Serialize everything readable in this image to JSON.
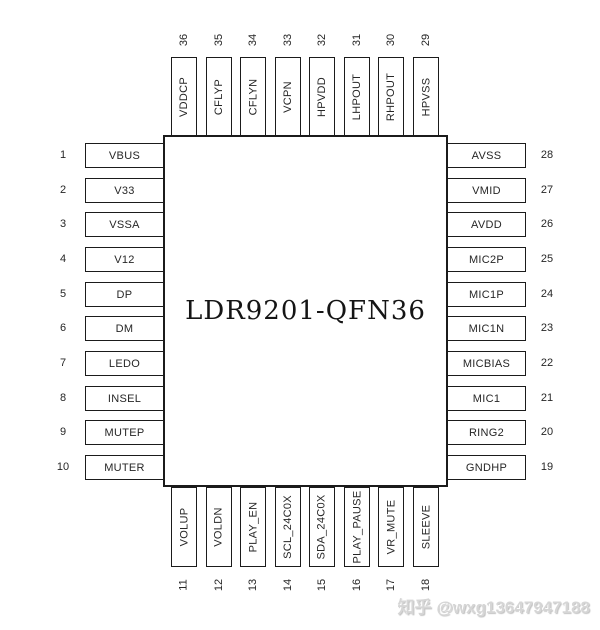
{
  "chip": {
    "label": "LDR9201-QFN36"
  },
  "left_pins": [
    {
      "num": "1",
      "label": "VBUS"
    },
    {
      "num": "2",
      "label": "V33"
    },
    {
      "num": "3",
      "label": "VSSA"
    },
    {
      "num": "4",
      "label": "V12"
    },
    {
      "num": "5",
      "label": "DP"
    },
    {
      "num": "6",
      "label": "DM"
    },
    {
      "num": "7",
      "label": "LEDO"
    },
    {
      "num": "8",
      "label": "INSEL"
    },
    {
      "num": "9",
      "label": "MUTEP"
    },
    {
      "num": "10",
      "label": "MUTER"
    }
  ],
  "right_pins": [
    {
      "num": "28",
      "label": "AVSS"
    },
    {
      "num": "27",
      "label": "VMID"
    },
    {
      "num": "26",
      "label": "AVDD"
    },
    {
      "num": "25",
      "label": "MIC2P"
    },
    {
      "num": "24",
      "label": "MIC1P"
    },
    {
      "num": "23",
      "label": "MIC1N"
    },
    {
      "num": "22",
      "label": "MICBIAS"
    },
    {
      "num": "21",
      "label": "MIC1"
    },
    {
      "num": "20",
      "label": "RING2"
    },
    {
      "num": "19",
      "label": "GNDHP"
    }
  ],
  "top_pins": [
    {
      "num": "36",
      "label": "VDDCP"
    },
    {
      "num": "35",
      "label": "CFLYP"
    },
    {
      "num": "34",
      "label": "CFLYN"
    },
    {
      "num": "33",
      "label": "VCPN"
    },
    {
      "num": "32",
      "label": "HPVDD"
    },
    {
      "num": "31",
      "label": "LHPOUT"
    },
    {
      "num": "30",
      "label": "RHPOUT"
    },
    {
      "num": "29",
      "label": "HPVSS"
    }
  ],
  "bottom_pins": [
    {
      "num": "11",
      "label": "VOLUP"
    },
    {
      "num": "12",
      "label": "VOLDN"
    },
    {
      "num": "13",
      "label": "PLAY_EN"
    },
    {
      "num": "14",
      "label": "SCL_24C0X"
    },
    {
      "num": "15",
      "label": "SDA_24C0X"
    },
    {
      "num": "16",
      "label": "PLAY_PAUSE"
    },
    {
      "num": "17",
      "label": "VR_MUTE"
    },
    {
      "num": "18",
      "label": "SLEEVE"
    }
  ],
  "watermark": {
    "text": "知乎 @wxg13647947188"
  }
}
